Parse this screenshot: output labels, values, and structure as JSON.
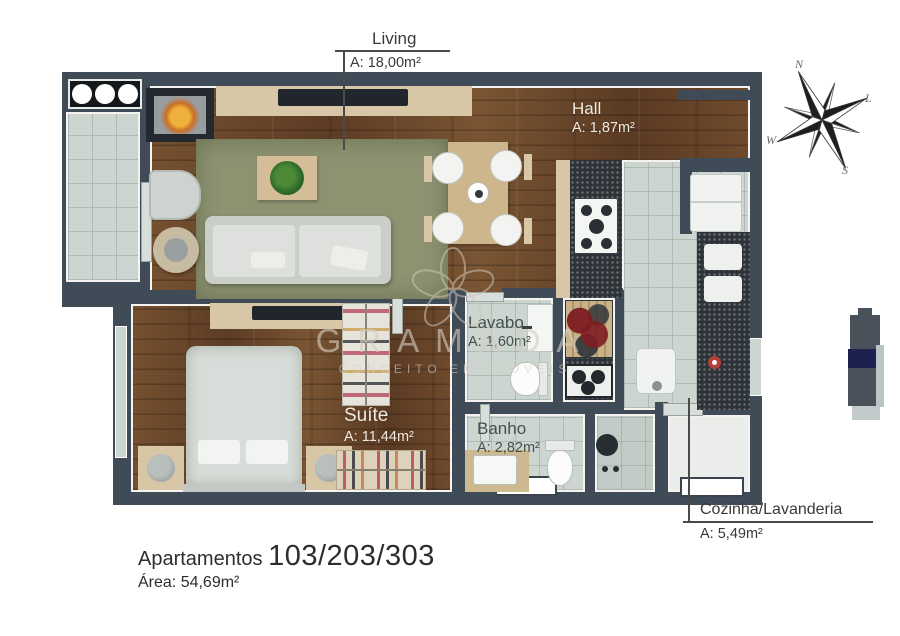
{
  "rooms": {
    "living": {
      "name": "Living",
      "area": "A: 18,00m²"
    },
    "hall": {
      "name": "Hall",
      "area": "A: 1,87m²"
    },
    "lavabo": {
      "name": "Lavabo",
      "area": "A: 1,60m²"
    },
    "suite": {
      "name": "Suíte",
      "area": "A: 11,44m²"
    },
    "banho": {
      "name": "Banho",
      "area": "A: 2,82m²"
    },
    "cozinha": {
      "name": "Cozinha/Lavanderia",
      "area": "A: 5,49m²"
    }
  },
  "footer": {
    "prefix": "Apartamentos",
    "numbers": "103/203/303",
    "area": "Área: 54,69m²"
  },
  "compass": {
    "north": "N",
    "east": "L",
    "south": "S",
    "west": "W"
  },
  "watermark": {
    "brand": "GRAMADA",
    "tagline": "CONCEITO EM IMÓVEIS"
  },
  "palette": {
    "wall": "#3f4b57",
    "wood": "#6a452c",
    "tile": "#ccd5d0",
    "counter_dark": "#2d3339",
    "rug_green": "#8d9271",
    "furniture_beige": "#d8c7a6",
    "accent_red": "#b23f38"
  }
}
